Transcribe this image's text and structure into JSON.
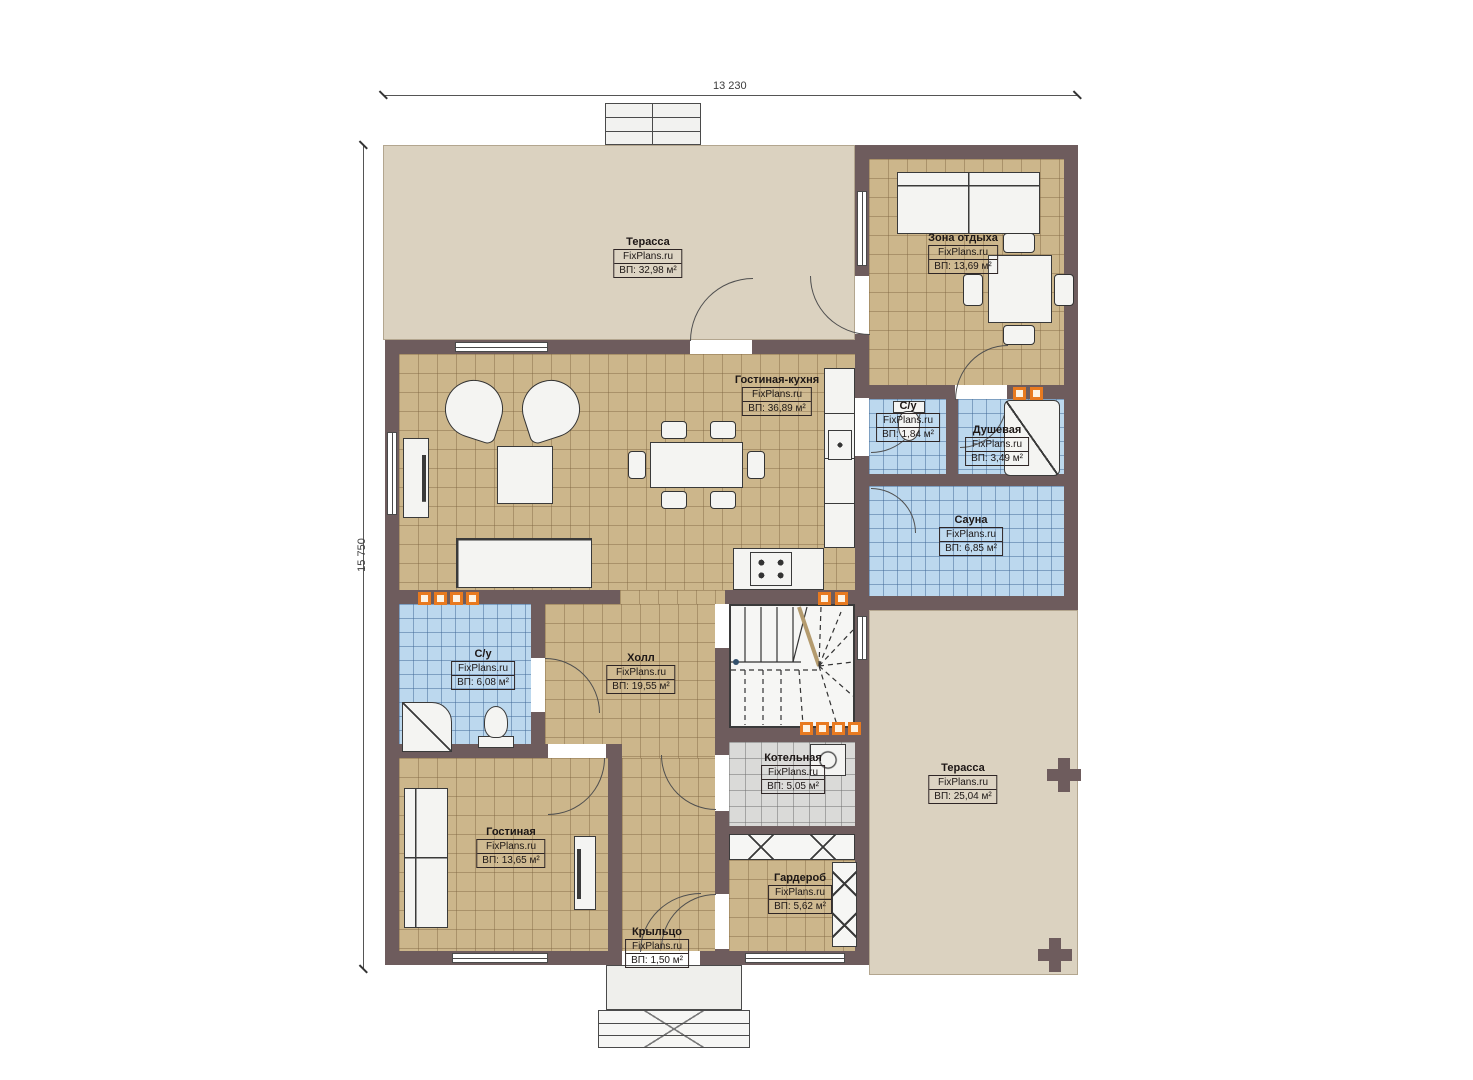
{
  "meta": {
    "brand": "FixPlans.ru"
  },
  "dimensions": {
    "width_label": "13 230",
    "height_label": "15 750"
  },
  "rooms": [
    {
      "id": "terrace-top",
      "name": "Терасса",
      "area": "ВП: 32,98 м²"
    },
    {
      "id": "lounge",
      "name": "Зона отдыха",
      "area": "ВП: 13,69 м²"
    },
    {
      "id": "living-kitchen",
      "name": "Гостиная-кухня",
      "area": "ВП: 36,89 м²"
    },
    {
      "id": "wc-top",
      "name": "С/у",
      "area": "ВП: 1,84 м²"
    },
    {
      "id": "shower-room",
      "name": "Душевая",
      "area": "ВП: 3,49 м²"
    },
    {
      "id": "sauna",
      "name": "Сауна",
      "area": "ВП: 6,85 м²"
    },
    {
      "id": "wc-left",
      "name": "С/у",
      "area": "ВП: 6,08 м²"
    },
    {
      "id": "hall",
      "name": "Холл",
      "area": "ВП: 19,55 м²"
    },
    {
      "id": "boiler",
      "name": "Котельная",
      "area": "ВП: 5,05 м²"
    },
    {
      "id": "living",
      "name": "Гостиная",
      "area": "ВП: 13,65 м²"
    },
    {
      "id": "wardrobe",
      "name": "Гардероб",
      "area": "ВП: 5,62 м²"
    },
    {
      "id": "porch",
      "name": "Крыльцо",
      "area": "ВП: 1,50 м²"
    },
    {
      "id": "terrace-right",
      "name": "Терасса",
      "area": "ВП: 25,04 м²"
    }
  ],
  "colors": {
    "wall": "#6e5c5d",
    "floor_tile_tan": "#ccb68b",
    "floor_tile_blue": "#bcd8ee",
    "terrace": "#dbd2c0",
    "boiler_tile": "#dadad8",
    "radiator_accent": "#e87a20"
  }
}
